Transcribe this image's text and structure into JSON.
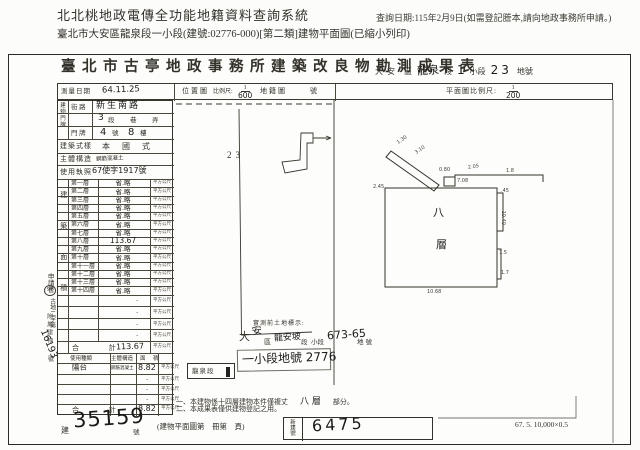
{
  "header": {
    "system_title": "北北桃地政電傳全功能地籍資料查詢系統",
    "query_date": "查詢日期:115年2月9日(如需登記謄本,請向地政事務所申請。)",
    "subtitle": "臺北市大安區龍泉段一小段(建號:02776-000)[第二類]建物平面圖(已縮小列印)"
  },
  "form": {
    "title": "臺北市古亭地政事務所建築改良物勘測成果表",
    "location": {
      "t1": "大安",
      "t2": "區",
      "hand_section": "龍泉",
      "t3": "段",
      "hand_sub": "1",
      "t4": "小段",
      "hand_parcel": "23",
      "t5": "地號"
    },
    "survey": {
      "label": "測量日期",
      "value": "64.11.25"
    },
    "scales": {
      "pos": "位置圖",
      "ratio": "比例尺:",
      "num": "1",
      "den": "600",
      "cad": "地籍圖",
      "no": "號",
      "plan": "平面圖比例尺:",
      "pnum": "1",
      "pden": "200"
    },
    "door": {
      "vertical": "建物門牌",
      "street_label": "街 路",
      "street": "新生南路",
      "sec_hand": "3",
      "sec1": "段",
      "sec2": "巷",
      "sec3": "弄",
      "door_label": "門 牌",
      "no_hand": "4",
      "no_t": "號",
      "fl_hand": "8",
      "fl_t": "樓"
    },
    "style": {
      "label": "建築式樣",
      "value": "本 國 式"
    },
    "structure": {
      "label": "主體構造",
      "value": "鋼筋混凝土"
    },
    "license": {
      "label": "使用執照",
      "value": "67使字1917號"
    },
    "area_vertical": "建築面積",
    "unit": "平方公尺",
    "dot": "·",
    "floors": [
      {
        "label": "第一層",
        "value": "省.略"
      },
      {
        "label": "第二層",
        "value": "省.略"
      },
      {
        "label": "第三層",
        "value": "省.略"
      },
      {
        "label": "第四層",
        "value": "省.略"
      },
      {
        "label": "第五層",
        "value": "省.略"
      },
      {
        "label": "第六層",
        "value": "省.略"
      },
      {
        "label": "第七層",
        "value": "省.略"
      },
      {
        "label": "第八層",
        "value": "113.67"
      },
      {
        "label": "第九層",
        "value": "省.略"
      },
      {
        "label": "第十層",
        "value": "省.略"
      },
      {
        "label": "第十一層",
        "value": "省.略"
      },
      {
        "label": "第十二層",
        "value": "省.略"
      },
      {
        "label": "第十三層",
        "value": "省.略"
      },
      {
        "label": "第十四層",
        "value": "省.略"
      }
    ],
    "total_label": "合 計",
    "floors_total": "113.67",
    "stamp": {
      "header": "申請書",
      "circle": "97",
      "body": "古地二字第",
      "number": "16193",
      "suffix": "號"
    },
    "annex": {
      "vertical": "附屬建物",
      "h1": "使用種類",
      "h2": "主體構造",
      "h3": "面 積",
      "use": "陽台",
      "structure": "鋼筋混凝土",
      "area": "8.82",
      "total": "8.82"
    }
  },
  "middle": {
    "premeasure": "實測前土地標示:",
    "d1": "大",
    "hand_d": "安",
    "d2": "區",
    "hand_sec": "龍安坡",
    "d3": "段",
    "d4": "小段",
    "hand_parcel": "673-65",
    "d5": "地號",
    "new_parcel": "一小段地號 2776",
    "stamp_box": "龍泉段",
    "note1a": "一、本建物係十四層建物本件僅複丈",
    "note1b": "八 層",
    "note1c": "部分。",
    "note2": "二、本成果表僅供建物登記之用。"
  },
  "plan": {
    "map_parcel": "23",
    "floor_char1": "八",
    "floor_char2": "層",
    "dims": [
      "2.45",
      "1.30",
      "3.10",
      "0.80",
      "2.05",
      "7.08",
      "1.8",
      ".45",
      "10.40",
      "1.5",
      "1.7",
      "10.68"
    ]
  },
  "bottom": {
    "b_label": "建",
    "b_hand": "35159",
    "b_suffix": "號",
    "page_note": "(建物平面圖第　冊第　頁)",
    "newno_label": "新建號",
    "newno_hand": "6475",
    "code": "67. 5. 10,000×0.5"
  }
}
